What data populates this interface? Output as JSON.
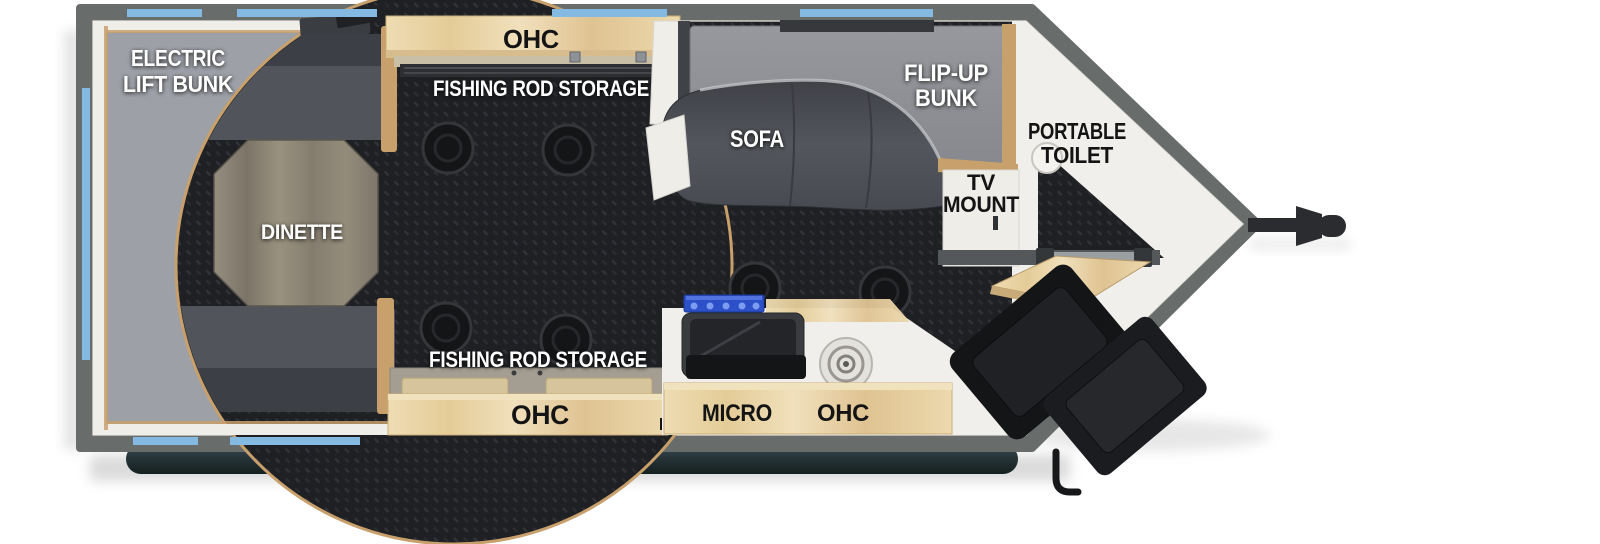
{
  "figure": {
    "type": "rv-floorplan",
    "description": "Top-view travel trailer floor plan with rear electric lift bunk, dinette, fishing rod storage, sofa with flip-up bunk, kitchen with microwave, TV mount wall, portable toilet in V-nose, fold-out entry steps and tongue hitch"
  },
  "areas": {
    "electric_lift_bunk": {
      "line1": "ELECTRIC",
      "line2": "LIFT BUNK"
    },
    "dinette": {
      "label": "DINETTE"
    },
    "ohc_top": {
      "label": "OHC"
    },
    "rod_storage_top": {
      "label": "FISHING ROD STORAGE"
    },
    "sofa": {
      "label": "SOFA"
    },
    "flip_up_bunk": {
      "line1": "FLIP-UP",
      "line2": "BUNK"
    },
    "portable_toilet": {
      "line1": "PORTABLE",
      "line2": "TOILET"
    },
    "tv_mount": {
      "line1": "TV",
      "line2": "MOUNT"
    },
    "rod_storage_bottom": {
      "label": "FISHING ROD STORAGE"
    },
    "ohc_bottom": {
      "label": "OHC"
    },
    "kitchen": {
      "micro_label": "MICRO",
      "ohc_label": "OHC"
    }
  },
  "colors": {
    "wall": "#686c6b",
    "window": "#84b9e2",
    "floor": "#1e2023",
    "floor_pattern": "#303237",
    "bunk_panel": "#9da0a7",
    "lining": "#efeee9",
    "wood_trim": "#c8a06c",
    "cushion": "#8f9196",
    "sofa": "#4c4f55",
    "sofa_dark": "#3c3f45",
    "white_floor": "#f0efeb",
    "table_wood": "#8e8678",
    "cabinet_wood": "#ead7ae",
    "bumper": "#26343a",
    "bumper_highlight": "#a9dcea",
    "hitch": "#2a2c2f",
    "cooktop_blue": "#2b50c8",
    "label_black": "#141414"
  }
}
